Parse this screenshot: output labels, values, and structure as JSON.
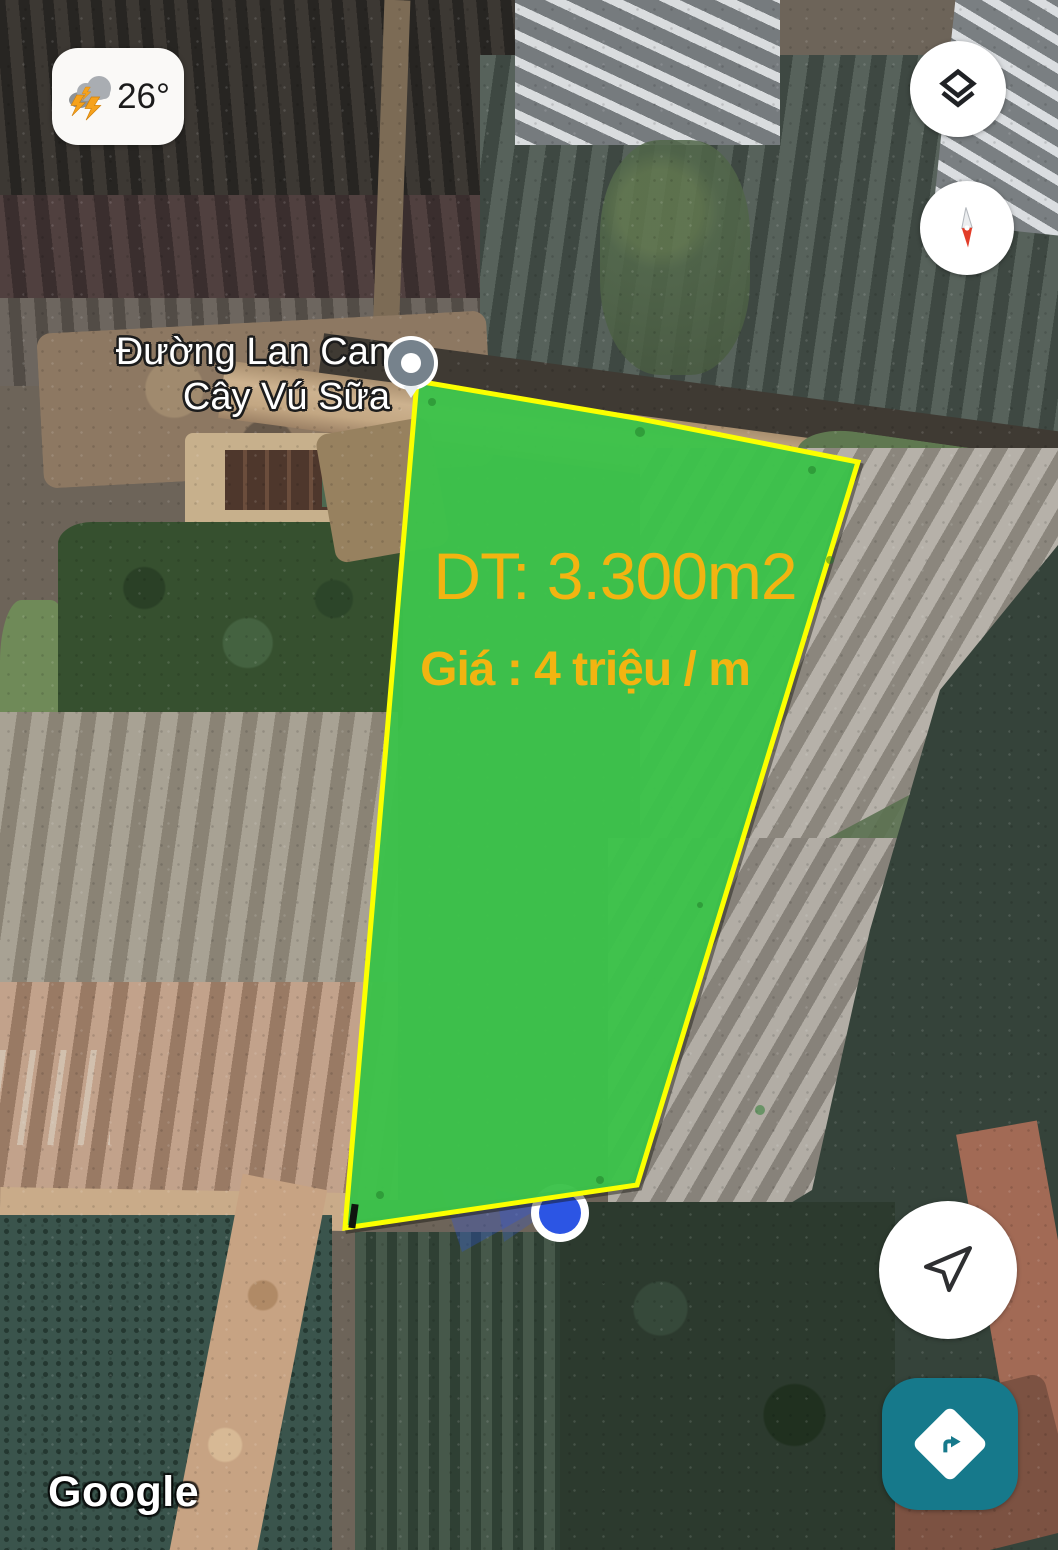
{
  "colors": {
    "plot-green": "#3cc24a",
    "plot-border": "#fbff00",
    "plot-text": "#f2b411",
    "directions-teal": "#16798b",
    "dot-blue": "#2c55e4"
  },
  "weather": {
    "temperature": "26°",
    "icon": "storm-lightning-icon"
  },
  "place_label": {
    "line1": "Đường Lan Can",
    "line2": "Cây Vú Sữa"
  },
  "plot": {
    "area": "DT: 3.300m2",
    "price": "Giá : 4 triệu / m"
  },
  "map_controls": {
    "layers_icon": "layers-icon",
    "compass_icon": "compass-needle-icon",
    "my_location_icon": "send-arrow-icon",
    "directions_icon": "turn-right-diamond-icon"
  },
  "attribution": {
    "logo_text": "Google"
  }
}
